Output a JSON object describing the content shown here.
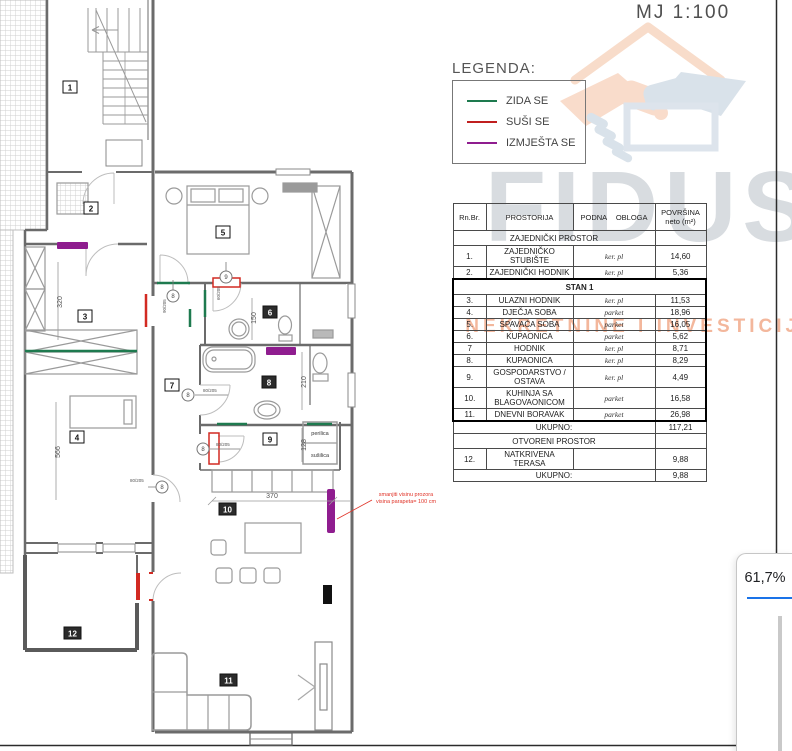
{
  "scale_label": "MJ 1:100",
  "legend": {
    "title": "LEGENDA:",
    "items": [
      {
        "label": "ZIDA SE",
        "color": "#1e7a4f"
      },
      {
        "label": "SUŠI SE",
        "color": "#c01f1f"
      },
      {
        "label": "IZMJEŠTA SE",
        "color": "#8f1d8f"
      }
    ]
  },
  "watermark": {
    "brand": "FIDUS",
    "tagline": "NEKRETNINE I INVESTICIJE"
  },
  "t": {
    "h": {
      "rn": "Rn.Br.",
      "pr": "PROSTORIJA",
      "po": "PODNA  OBLOGA",
      "pv1": "POVRŠINA",
      "pv2": "neto (m²)"
    },
    "sec1": "ZAJEDNIČKI PROSTOR",
    "sec2": "STAN 1",
    "sec3": "OTVORENI PROSTOR",
    "uk": "UKUPNO:",
    "tot1": "117,21",
    "tot2": "9,88",
    "rows": [
      {
        "no": "1.",
        "name": "ZAJEDNIČKO STUBIŠTE",
        "floor": "ker. pl",
        "area": "14,60"
      },
      {
        "no": "2.",
        "name": "ZAJEDNIČKI HODNIK",
        "floor": "ker. pl",
        "area": "5,36"
      },
      {
        "no": "3.",
        "name": "ULAZNI HODNIK",
        "floor": "ker. pl",
        "area": "11,53"
      },
      {
        "no": "4.",
        "name": "DJEČJA SOBA",
        "floor": "parket",
        "area": "18,96"
      },
      {
        "no": "5.",
        "name": "SPAVAĆA SOBA",
        "floor": "parket",
        "area": "16,05"
      },
      {
        "no": "6.",
        "name": "KUPAONICA",
        "floor": "parket",
        "area": "5,62"
      },
      {
        "no": "7",
        "name": "HODNIK",
        "floor": "ker. pl",
        "area": "8,71"
      },
      {
        "no": "8.",
        "name": "KUPAONICA",
        "floor": "ker. pl",
        "area": "8,29"
      },
      {
        "no": "9.",
        "name": "GOSPODARSTVO / OSTAVA",
        "floor": "ker. pl",
        "area": "4,49"
      },
      {
        "no": "10.",
        "name": "KUHINJA SA BLAGOVAONICOM",
        "floor": "parket",
        "area": "16,58"
      },
      {
        "no": "11.",
        "name": "DNEVNI BORAVAK",
        "floor": "parket",
        "area": "26,98"
      },
      {
        "no": "12.",
        "name": "NATKRIVENA TERASA",
        "floor": "",
        "area": "9,88"
      }
    ]
  },
  "plan": {
    "rooms": [
      "1",
      "2",
      "3",
      "4",
      "5",
      "6",
      "7",
      "8",
      "9",
      "10",
      "11",
      "12"
    ],
    "dims": {
      "d320": "320",
      "d566": "566",
      "d150": "150",
      "d210": "210",
      "d128": "128",
      "d370": "370"
    },
    "labels": {
      "perilica": "perilica",
      "susilica": "sušilica"
    },
    "note": [
      "smanjiti visinu prozora",
      "visina parapeta= 100 cm"
    ],
    "door_tags": [
      {
        "no": "8",
        "size": "90/205"
      },
      {
        "no": "9",
        "size": "60/205"
      },
      {
        "no": "8",
        "size": "80/205"
      },
      {
        "no": "8",
        "size": "80/205"
      },
      {
        "no": "8",
        "size": "80/205"
      }
    ]
  },
  "viewer": {
    "zoom_value": "61,7%"
  },
  "colors": {
    "zida_se": "#1e7a4f",
    "susi_se": "#c01f1f",
    "izmjesta_se": "#8f1d8f",
    "accent_blue": "#1a73e8"
  }
}
